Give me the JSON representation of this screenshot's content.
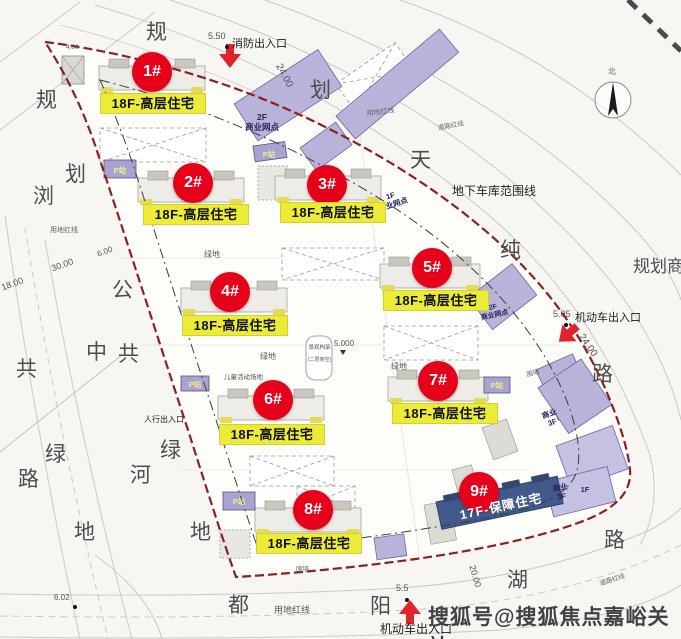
{
  "colors": {
    "badge_red": "#e60019",
    "label_yellow": "#ecec38",
    "building_purple": "#b9b3d9",
    "building_navy": "#42598b",
    "boundary_red": "#8e2020"
  },
  "buildings": [
    {
      "badge": "1#",
      "label": "18F-高层住宅"
    },
    {
      "badge": "2#",
      "label": "18F-高层住宅"
    },
    {
      "badge": "3#",
      "label": "18F-高层住宅"
    },
    {
      "badge": "4#",
      "label": "18F-高层住宅"
    },
    {
      "badge": "5#",
      "label": "18F-高层住宅"
    },
    {
      "badge": "6#",
      "label": "18F-高层住宅"
    },
    {
      "badge": "7#",
      "label": "18F-高层住宅"
    },
    {
      "badge": "8#",
      "label": "18F-高层住宅"
    },
    {
      "badge": "9#",
      "label": "17F-保障住宅"
    }
  ],
  "entrances": {
    "fire": {
      "label": "消防出入口",
      "elevation": "5.50"
    },
    "vehicle_east": {
      "label": "机动车出入口",
      "elevation": "5.05"
    },
    "vehicle_south": {
      "label": "机动车出入口",
      "elevation": "5.5"
    },
    "pedestrian": {
      "label": "人行出入口"
    }
  },
  "boundary_labels": {
    "garage": "地下车库范围线",
    "site_redline": "用地红线",
    "road_redline": "道路红线"
  },
  "roads": {
    "top": [
      "规",
      "划",
      "天",
      "纯"
    ],
    "left": [
      "规",
      "划",
      "浏",
      "公",
      "中",
      "共",
      "共",
      "绿",
      "路",
      "河",
      "绿",
      "地",
      "地"
    ],
    "right_chars": [
      "路"
    ],
    "right_label": "规划商",
    "bottom": [
      "路",
      "湖",
      "阳",
      "都"
    ]
  },
  "dims": {
    "top_width": "24.00",
    "east_width": "24.00",
    "left_a": "30.00",
    "left_b": "18.00",
    "left_c": "6.00",
    "corner": "6.02",
    "south_width": "20.00",
    "south_gate": "5.5",
    "top_small": "4.00",
    "site_level": "5.000"
  },
  "site_texts": {
    "green": "绿地",
    "fence": "围墙",
    "children": "儿童活动场地",
    "pergola_1": "景观构架",
    "pergola_2": "(二层架空)",
    "parking": "P站"
  },
  "commercial": {
    "c2f_floor": "2F",
    "c1f_floor": "1F",
    "name": "商业网点",
    "biz": "商业",
    "f3": "3F",
    "f1": "1F"
  },
  "compass": {
    "label": "北"
  },
  "watermark": "搜狐号@搜狐焦点嘉峪关站"
}
